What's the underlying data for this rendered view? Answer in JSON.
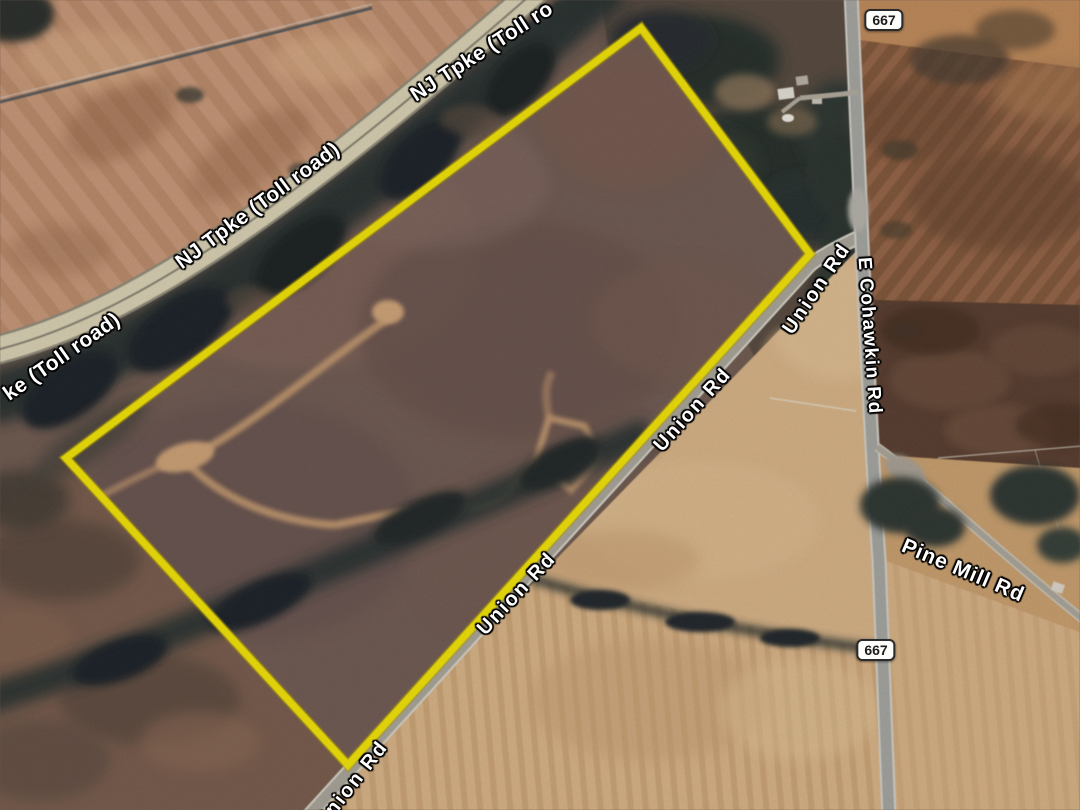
{
  "map": {
    "road_labels": [
      {
        "id": "nj-tpke-left-partial",
        "text": "ke (Toll road)"
      },
      {
        "id": "nj-tpke-main",
        "text": "NJ Tpke (Toll road)"
      },
      {
        "id": "nj-tpke-top-partial",
        "text": "NJ Tpke (Toll ro"
      },
      {
        "id": "union-rd-upper",
        "text": "Union Rd"
      },
      {
        "id": "union-rd-middle",
        "text": "Union Rd"
      },
      {
        "id": "union-rd-lower",
        "text": "Union Rd"
      },
      {
        "id": "union-rd-bottom",
        "text": "Union Rd"
      },
      {
        "id": "e-cohawkin-rd",
        "text": "E Cohawkin Rd"
      },
      {
        "id": "pine-mill-rd",
        "text": "Pine Mill Rd"
      }
    ],
    "route_shields": [
      {
        "id": "route-667-north",
        "text": "667"
      },
      {
        "id": "route-667-south",
        "text": "667"
      }
    ],
    "colors": {
      "boundary_yellow": "#f4e60a",
      "label_text": "#ffffff",
      "label_halo": "#000000",
      "shield_background": "#fdfdfa",
      "shield_border": "#2b2b2b",
      "shield_text": "#1d1d1d"
    }
  }
}
